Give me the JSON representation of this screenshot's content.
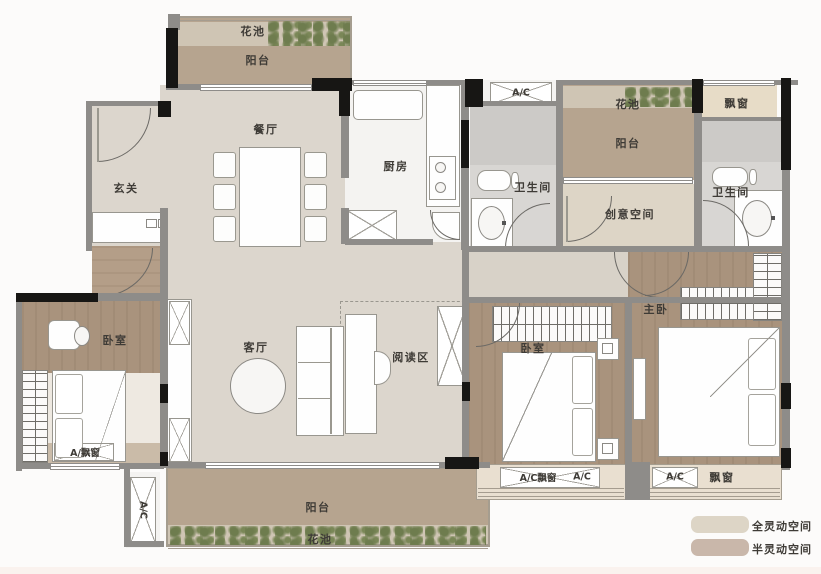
{
  "rooms": {
    "foyer": "玄关",
    "dining": "餐厅",
    "kitchen": "厨房",
    "living": "客厅",
    "reading": "阅读区",
    "creative": "创意空间",
    "bedroom_left": "卧室",
    "bedroom_mid": "卧室",
    "master": "主卧",
    "bath_left": "卫生间",
    "bath_right": "卫生间"
  },
  "outdoor": {
    "flower_top": "花池",
    "balcony_top": "阳台",
    "flower_right": "花池",
    "balcony_right": "阳台",
    "flower_bottom": "花池",
    "balcony_bottom": "阳台",
    "bay_top_right": "飘窗",
    "bay_master": "飘窗"
  },
  "ac": {
    "top": "A/C",
    "left": "A/C",
    "bedroom_left_bay": "A/飘窗",
    "bedroom_mid_bay": "A/C飘窗",
    "bedroom_mid_bay2": "A/C",
    "master_bay": "A/C"
  },
  "legend": {
    "items": [
      {
        "label": "全灵动空间",
        "color": "#ddd5c6"
      },
      {
        "label": "半灵动空间",
        "color": "#c9b7aa"
      }
    ]
  }
}
